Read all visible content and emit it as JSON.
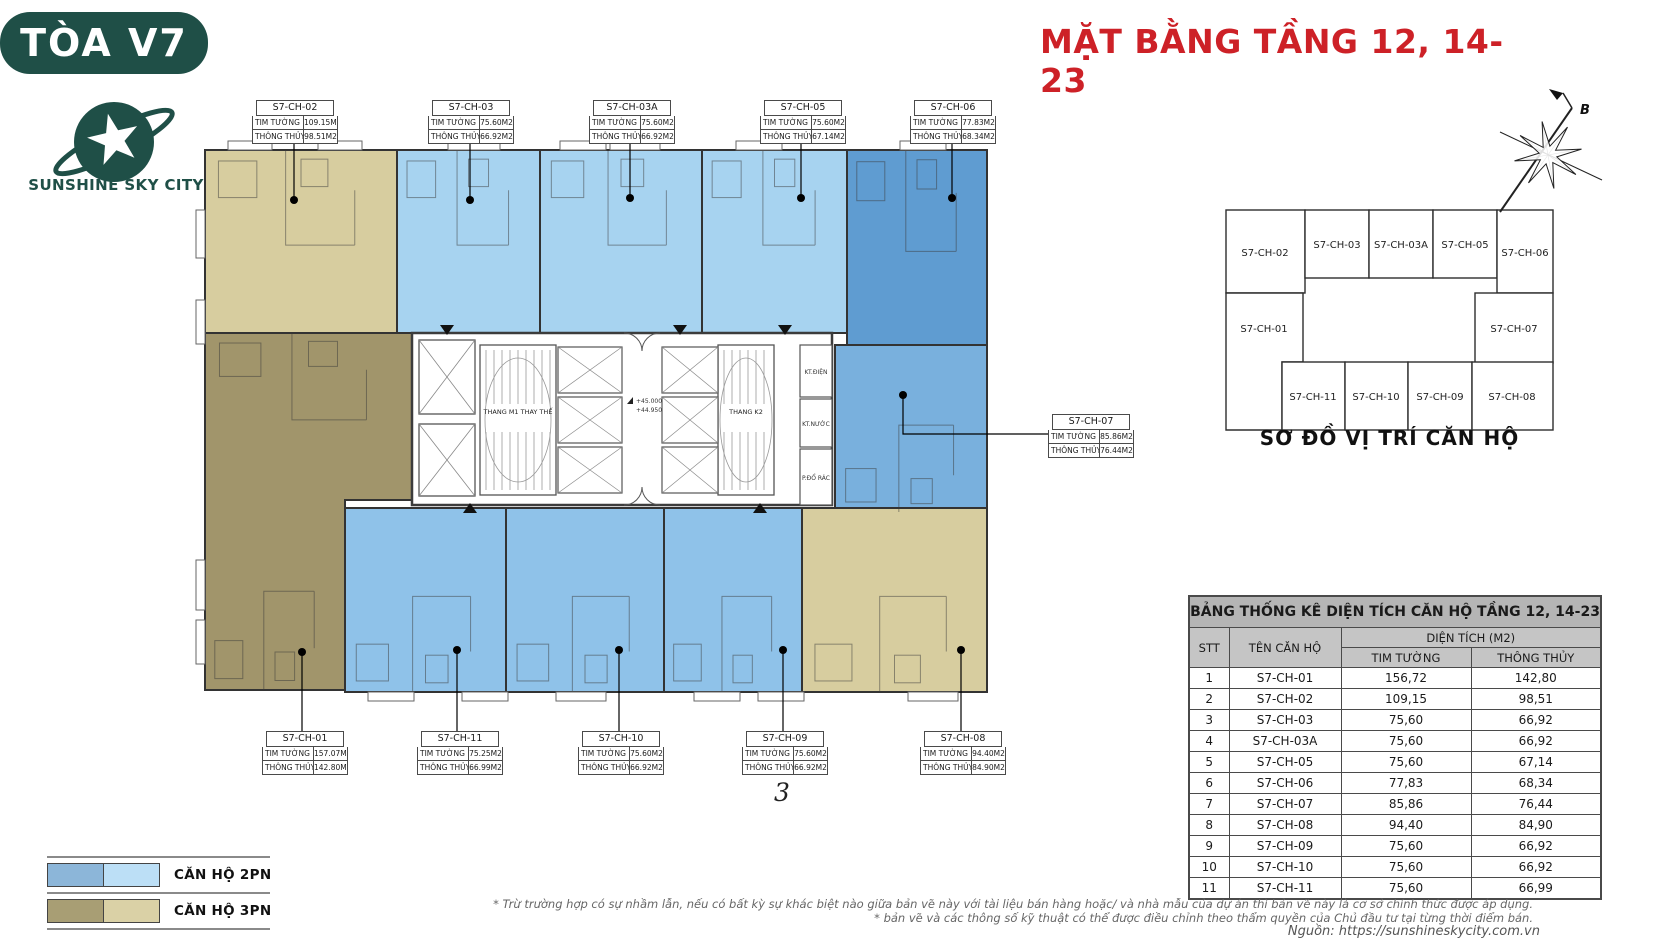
{
  "header": {
    "building_tag": "TÒA V7",
    "brand_name": "SUNSHINE SKY CITY",
    "page_title": "MẶT BẰNG TẦNG 12, 14-23"
  },
  "colors": {
    "brand_green": "#1f4f47",
    "title_red": "#cd2127",
    "unit_2pn_light": "#a7d3f0",
    "unit_2pn_mid": "#8fc2e9",
    "unit_2pn_dark": "#5f9cd1",
    "unit_2pn_dark2": "#79b0dd",
    "unit_3pn_light": "#d7cd9f",
    "unit_3pn_dark": "#a1956b"
  },
  "floor_plan": {
    "label_row1": "TIM TƯỜNG",
    "label_row2": "THÔNG THỦY",
    "units": [
      {
        "id": "S7-CH-02",
        "tim_tuong": "109.15M2",
        "thong_thuy": "98.51M2",
        "color_key": "unit_3pn_light"
      },
      {
        "id": "S7-CH-03",
        "tim_tuong": "75.60M2",
        "thong_thuy": "66.92M2",
        "color_key": "unit_2pn_light"
      },
      {
        "id": "S7-CH-03A",
        "tim_tuong": "75.60M2",
        "thong_thuy": "66.92M2",
        "color_key": "unit_2pn_light"
      },
      {
        "id": "S7-CH-05",
        "tim_tuong": "75.60M2",
        "thong_thuy": "67.14M2",
        "color_key": "unit_2pn_light"
      },
      {
        "id": "S7-CH-06",
        "tim_tuong": "77.83M2",
        "thong_thuy": "68.34M2",
        "color_key": "unit_2pn_dark"
      },
      {
        "id": "S7-CH-07",
        "tim_tuong": "85.86M2",
        "thong_thuy": "76.44M2",
        "color_key": "unit_2pn_dark2"
      },
      {
        "id": "S7-CH-01",
        "tim_tuong": "157.07M2",
        "thong_thuy": "142.80M2",
        "color_key": "unit_3pn_dark"
      },
      {
        "id": "S7-CH-11",
        "tim_tuong": "75.25M2",
        "thong_thuy": "66.99M2",
        "color_key": "unit_2pn_mid"
      },
      {
        "id": "S7-CH-10",
        "tim_tuong": "75.60M2",
        "thong_thuy": "66.92M2",
        "color_key": "unit_2pn_mid"
      },
      {
        "id": "S7-CH-09",
        "tim_tuong": "75.60M2",
        "thong_thuy": "66.92M2",
        "color_key": "unit_2pn_mid"
      },
      {
        "id": "S7-CH-08",
        "tim_tuong": "94.40M2",
        "thong_thuy": "84.90M2",
        "color_key": "unit_3pn_light"
      }
    ],
    "core_labels": {
      "stair1": "THANG M1 THAY THẾ",
      "stair2": "THANG K2",
      "elev1": "+45.000",
      "elev2": "+44.950",
      "kt_dien": "KT.ĐIỆN",
      "kt_nuoc": "KT.NƯỚC",
      "rac": "P.ĐỔ RÁC"
    }
  },
  "compass": {
    "north_label": "B"
  },
  "key_plan": {
    "title": "SƠ ĐỒ VỊ TRÍ CĂN HỘ",
    "cells": [
      "S7-CH-02",
      "S7-CH-03",
      "S7-CH-03A",
      "S7-CH-05",
      "S7-CH-06",
      "S7-CH-01",
      "S7-CH-07",
      "S7-CH-11",
      "S7-CH-10",
      "S7-CH-09",
      "S7-CH-08"
    ]
  },
  "area_table": {
    "title": "BẢNG THỐNG KÊ DIỆN TÍCH CĂN HỘ TẦNG 12, 14-23",
    "headers": {
      "stt": "STT",
      "name": "TÊN CĂN HỘ",
      "area": "DIỆN TÍCH (M2)",
      "tim_tuong": "TIM TƯỜNG",
      "thong_thuy": "THÔNG THỦY"
    },
    "rows": [
      [
        "1",
        "S7-CH-01",
        "156,72",
        "142,80"
      ],
      [
        "2",
        "S7-CH-02",
        "109,15",
        "98,51"
      ],
      [
        "3",
        "S7-CH-03",
        "75,60",
        "66,92"
      ],
      [
        "4",
        "S7-CH-03A",
        "75,60",
        "66,92"
      ],
      [
        "5",
        "S7-CH-05",
        "75,60",
        "67,14"
      ],
      [
        "6",
        "S7-CH-06",
        "77,83",
        "68,34"
      ],
      [
        "7",
        "S7-CH-07",
        "85,86",
        "76,44"
      ],
      [
        "8",
        "S7-CH-08",
        "94,40",
        "84,90"
      ],
      [
        "9",
        "S7-CH-09",
        "75,60",
        "66,92"
      ],
      [
        "10",
        "S7-CH-10",
        "75,60",
        "66,92"
      ],
      [
        "11",
        "S7-CH-11",
        "75,60",
        "66,99"
      ]
    ]
  },
  "legend": {
    "items": [
      {
        "label": "CĂN HỘ 2PN",
        "swatch": [
          "#8cb6d9",
          "#bcdff6"
        ]
      },
      {
        "label": "CĂN HỘ 3PN",
        "swatch": [
          "#a89e74",
          "#dad1a6"
        ]
      }
    ]
  },
  "footnotes": {
    "line1": "* Trừ trường hợp có sự nhầm lẫn, nếu có bất kỳ sự khác biệt nào giữa bản vẽ này với tài liệu bán hàng hoặc/ và nhà mẫu của dự án thì bản vẽ này là cơ sở chính thức được áp dụng.",
    "line2": "* bản vẽ và các thông số kỹ thuật có thể được điều chỉnh theo thẩm quyền của Chủ đầu tư tại từng thời điểm bán.",
    "source": "Nguồn: https://sunshineskycity.com.vn"
  },
  "page_mark": "3"
}
